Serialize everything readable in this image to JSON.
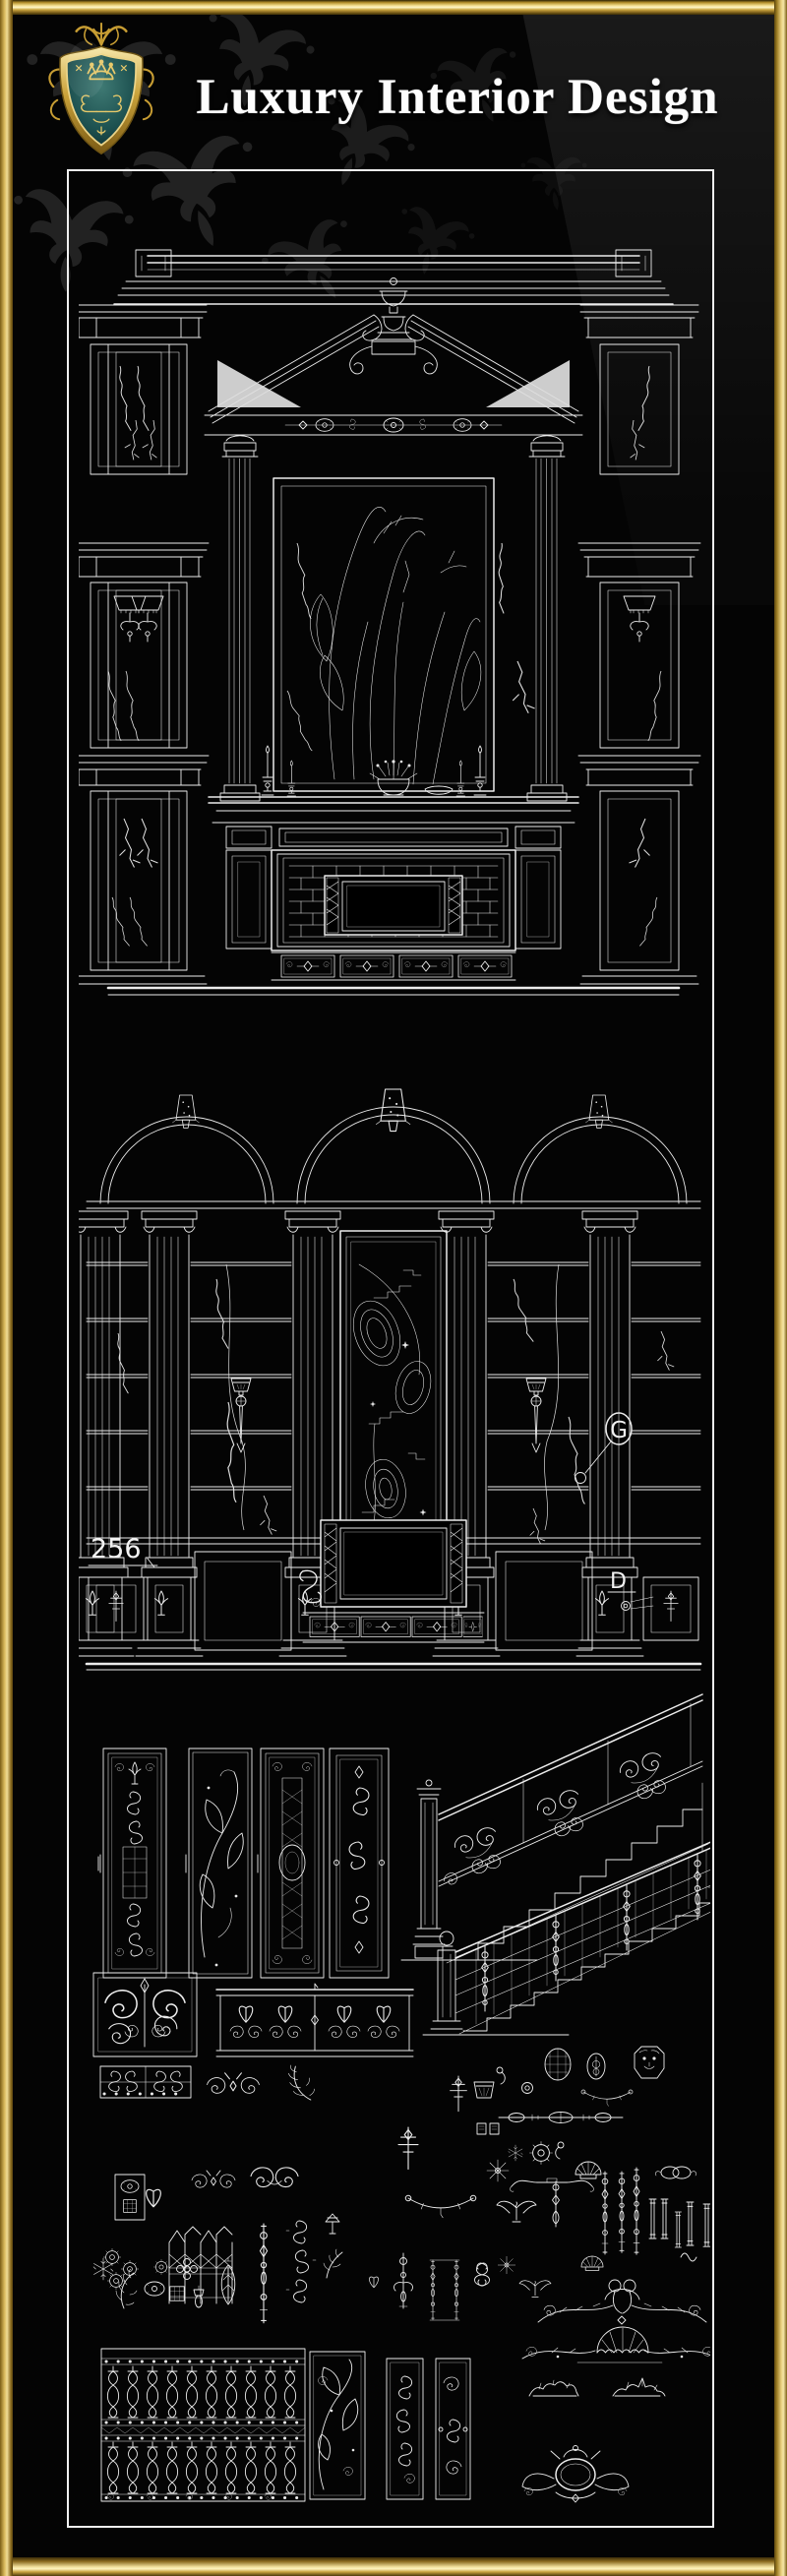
{
  "header": {
    "title": "Luxury Interior Design",
    "logo_icon": "heraldic-shield-crest-icon"
  },
  "frame": {
    "kind": "gold-picture-frame",
    "gold_light": "#f7e7a0",
    "gold_mid": "#c9a13b",
    "gold_dark": "#6b5212"
  },
  "palette": {
    "background": "#000000",
    "drawing_line": "#ececec",
    "panel_border": "#f0f0f0",
    "damask": "#232323",
    "crest_teal": "#1d5150",
    "crest_gold": "#e2c060"
  },
  "figures": {
    "fireplace": {
      "icon": "fireplace-elevation-drawing-icon"
    },
    "wall": {
      "icon": "arched-wall-elevation-drawing-icon",
      "dimension": "256",
      "tag_g": "G",
      "tag_d": "D"
    },
    "collection": {
      "icon": "ironwork-ornament-collection-icon"
    }
  }
}
